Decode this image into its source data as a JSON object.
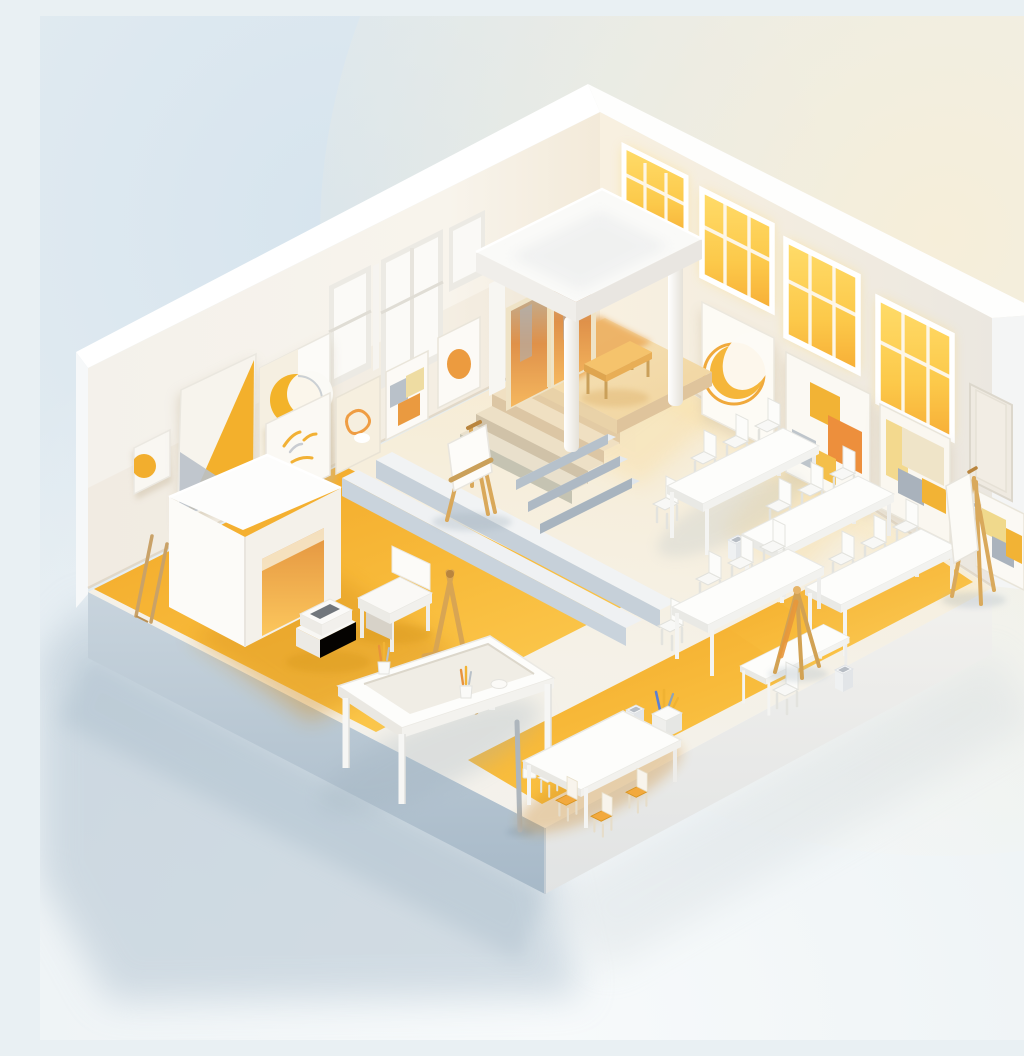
{
  "scene": {
    "type": "3d-isometric-illustration",
    "subject": "miniature art studio classroom diorama",
    "style": "minimal low-poly 3D render, white with yellow accents, cutaway corner room on a plinth",
    "alt": "Isometric 3D cutaway of a white art studio classroom: glowing yellow windows and abstract framed artwork on two walls, a corner entrance canopy with columns and a wooden bench, steps down to a floor with yellow zones, a white booth, painting easels, a large work table with brush cups, rows of white tables and chairs, and small yellow chairs at a front table.",
    "palette": {
      "accent_yellow": "#F3B02C",
      "glow_yellow": "#FFD75A",
      "accent_orange": "#EC9B3F",
      "wall_white": "#F7F4EE",
      "floor_white": "#F4F1EA",
      "stage_warm": "#F3DFB6",
      "wood": "#D9A65C",
      "shadow_blue": "#AEBFCC",
      "plinth_blue": "#B6C5D2",
      "background_blue": "#D9E6EE",
      "background_cream": "#F5EEDC"
    },
    "objects": [
      "left-wall",
      "right-wall",
      "glowing-windows",
      "abstract-wall-art",
      "entrance-canopy",
      "orange-doors",
      "corner-platform",
      "staircase",
      "long-floor-steps",
      "collapsed-step-ramp",
      "white-booth",
      "yellow-floor-zones",
      "stage-easel",
      "a-frame-easel",
      "tripod-easel",
      "wall-easel",
      "work-table-with-brush-cups",
      "class-tables",
      "white-chairs",
      "yellow-chairs",
      "wooden-bench",
      "side-bench",
      "supply-box",
      "brush-box",
      "trash-bins",
      "lamp-post",
      "leaning-sticks",
      "base-plinth"
    ]
  }
}
